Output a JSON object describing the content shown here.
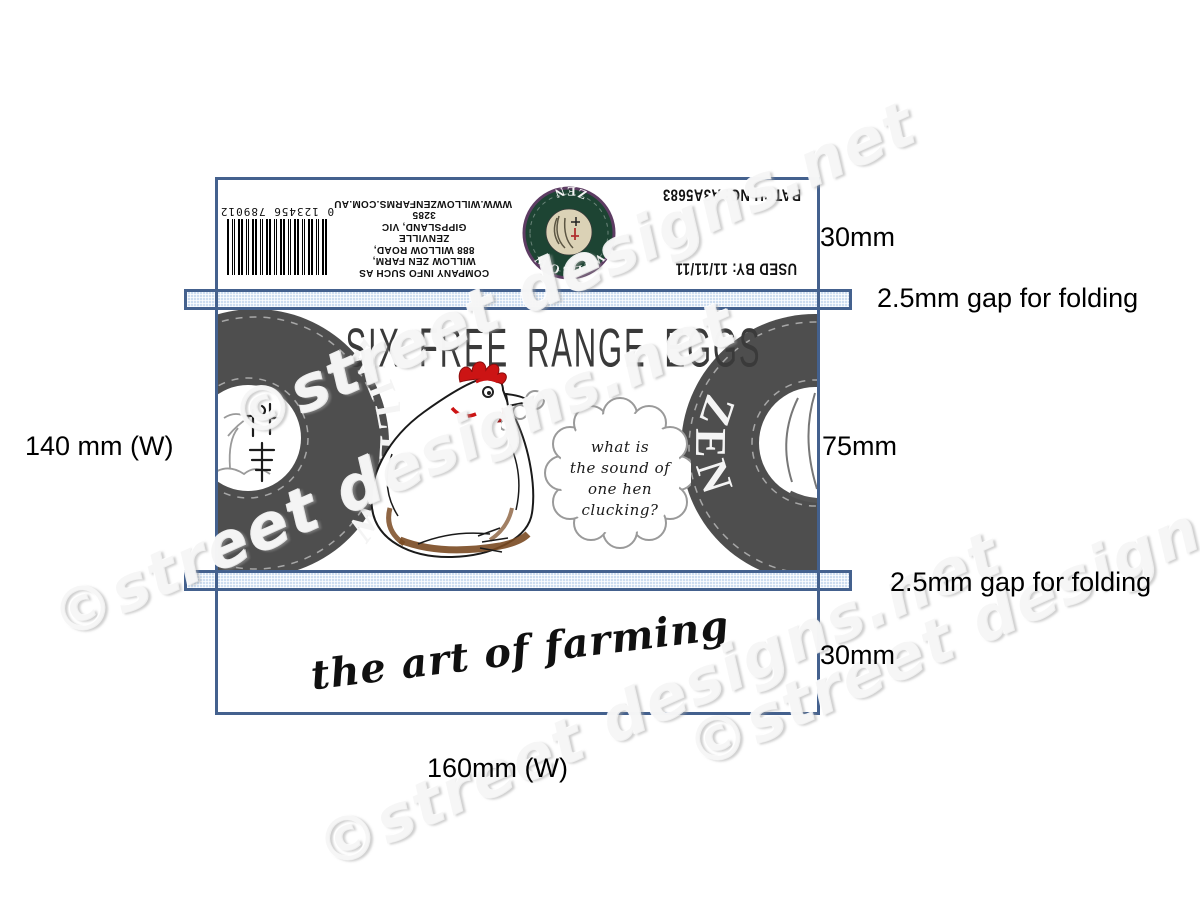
{
  "dims": {
    "top_flap": "30mm",
    "gap_top": "2.5mm gap for folding",
    "side_height": "140 mm (W)",
    "front_height": "75mm",
    "gap_bottom": "2.5mm gap for folding",
    "bottom_flap": "30mm",
    "total_width": "160mm (W)"
  },
  "top_flap": {
    "used_by": "USED BY: 11/11/11",
    "batch_no": "BATCH NO: A3A5683",
    "company_lines": [
      "COMPANY INFO SUCH AS",
      "WILLOW ZEN FARM,",
      "888 WILLOW ROAD,",
      "ZENVILLE",
      "GIPPSLAND, VIC",
      "3285",
      "WWW.WILLOWZENFARMS.COM.AU"
    ],
    "barcode_number": "0 123456 789012",
    "logo_top_text": "WILLOW",
    "logo_bottom_text": "ZEN",
    "seal_characters": "柳禅"
  },
  "front_panel": {
    "headline": "SIX FREE RANGE EGGS",
    "left_badge_word": "WILLOW",
    "right_badge_word": "ZEN",
    "thought_lines": [
      "what is",
      "the sound of",
      "one hen",
      "clucking?"
    ]
  },
  "bottom_flap": {
    "tagline": "the art of farming"
  },
  "watermark": {
    "text": "©street designs.net"
  },
  "colors": {
    "outline_blue": "#44618e",
    "fold_strip_fill": "#cdddf0",
    "badge_gray": "#4e4e4e",
    "logo_green": "#1d4433",
    "logo_ring_purple": "#5d3c63",
    "accent_red": "#cc1414",
    "shading_brown": "#7a4a22"
  }
}
